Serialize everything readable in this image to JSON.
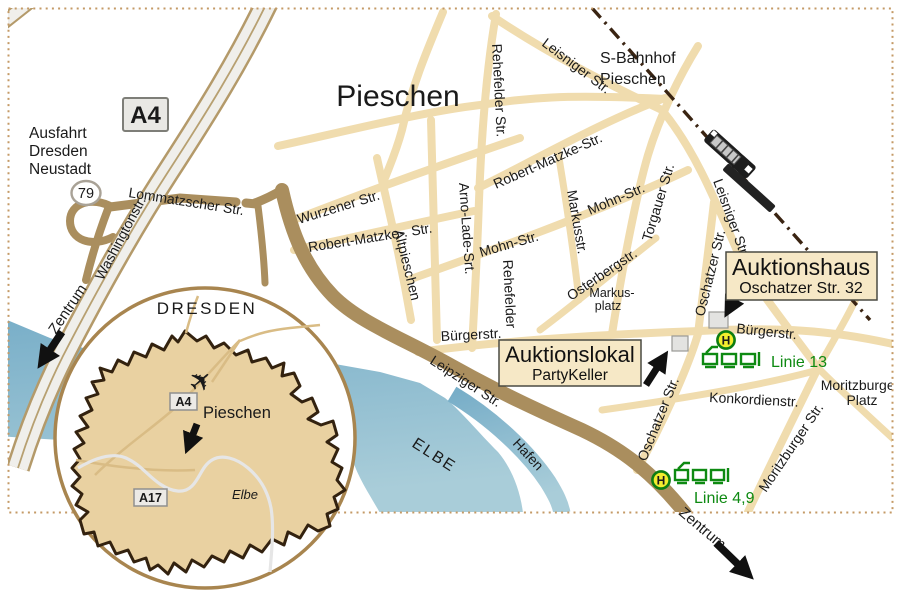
{
  "map": {
    "district_label": "Pieschen",
    "sbahn_station": {
      "line1": "S-Bahnhof",
      "line2": "Pieschen"
    },
    "motorway_exit": {
      "line1": "Ausfahrt",
      "line2": "Dresden",
      "line3": "Neustadt"
    },
    "badges": {
      "a4": "A4",
      "ramp": "79"
    },
    "streets": {
      "lommatzscher": "Lommatzscher Str.",
      "washington": "Washingtonstr.",
      "wurzener": "Wurzener Str.",
      "robert_matzke_west": "Robert-Matzke-.  Str.",
      "robert_matzke_east": "Robert-Matzke-Str.",
      "rehefelder_north": "Rehefelder Str.",
      "rehefelder_south": "Rehefelder",
      "altpieschen": "Altpieschen",
      "arno_lade": "Arno-Lade-Srt.",
      "mohn_west": "Mohn-Str.",
      "mohn_east": "Mohn-Str.",
      "markusstr": "Markusstr.",
      "torgauer": "Torgauer Str.",
      "leisniger_north": "Leisniger Str.",
      "leisniger_south": "Leisniger Str.",
      "osterbergstr": "Osterbergstr.",
      "buergerstr_west": "Bürgerstr.",
      "buergerstr_east": "Bürgerstr.",
      "oschatzer_north": "Oschatzer Str.",
      "oschatzer_south": "Oschatzer Str.",
      "konkordienstr": "Konkordienstr.",
      "moritzburger": "Moritzburger Str.",
      "leipziger": "Leipziger Str."
    },
    "places": {
      "markusplatz_line1": "Markus-",
      "markusplatz_line2": "platz",
      "moritzburger_platz_line1": "Moritzburger",
      "moritzburger_platz_line2": "Platz"
    },
    "water": {
      "river": "ELBE",
      "harbor": "Hafen"
    },
    "zentrum_left": "Zentrum",
    "zentrum_right": "Zentrum",
    "auktionshaus_box": {
      "title": "Auktionshaus",
      "subtitle": "Oschatzer Str. 32"
    },
    "auktionslokal_box": {
      "title": "Auktionslokal",
      "subtitle": "PartyKeller"
    },
    "tram_13": {
      "stop": "H",
      "label": "Linie 13"
    },
    "tram_49": {
      "stop": "H",
      "label": "Linie 4,9"
    }
  },
  "inset": {
    "city": "DRESDEN",
    "district": "Pieschen",
    "badge_a4": "A4",
    "badge_a17": "A17",
    "river": "Elbe"
  },
  "colors": {
    "road_minor": "#f0dcae",
    "road_major": "#aa8e5e",
    "autobahn_fill": "#f0efeb",
    "autobahn_edge": "#b49a6a",
    "river_blue": "#7fb3cb",
    "river_light": "#a9cdd9",
    "railway": "#3a2412",
    "tram_green": "#0e8a12",
    "stop_yellow": "#f3ed2e",
    "label_box_fill": "#f6e8c6",
    "building_gray": "#e3e3e1",
    "inset_land": "#e9d1a1",
    "inset_border": "#33220f",
    "border_dots": "#c49a66"
  }
}
